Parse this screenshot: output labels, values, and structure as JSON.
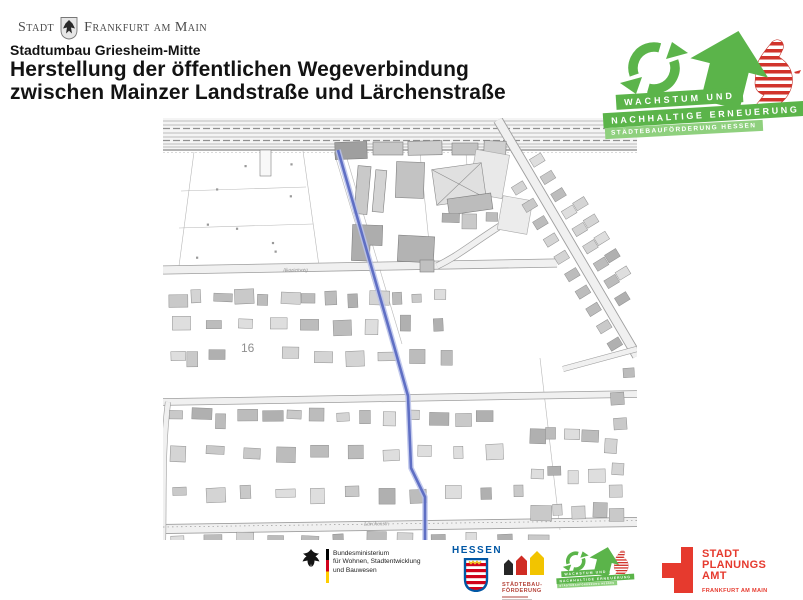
{
  "colors": {
    "green": "#5bb44a",
    "light_green": "#8fd07e",
    "hessen_blue": "#0057a5",
    "funding_red": "#b5443a",
    "planning_red": "#e63a2e",
    "path_blue": "#5f6fc4"
  },
  "header": {
    "city_logo": {
      "word1": "Stadt",
      "word2": "Frankfurt am Main"
    },
    "subtitle": "Stadtumbau Griesheim-Mitte",
    "title1": "Herstellung der öffentlichen Wegeverbindung",
    "title2": "zwischen Mainzer Landstraße und Lärchenstraße"
  },
  "program_logo": {
    "line1": "WACHSTUM UND",
    "line2": "NACHHALTIGE ERNEUERUNG",
    "line3": "STÄDTEBAUFÖRDERUNG HESSEN"
  },
  "map": {
    "street_label_mid": "Akazienweg",
    "street_label_bottom": "Lärchenstr.",
    "block_number": "16"
  },
  "footer": {
    "ministry": {
      "line1": "Bundesministerium",
      "line2": "für Wohnen, Stadtentwicklung",
      "line3": "und Bauwesen"
    },
    "hessen": {
      "wordmark": "HESSEN"
    },
    "funding": {
      "line1": "STÄDTEBAU-",
      "line2": "FÖRDERUNG"
    },
    "planning": {
      "line1": "STADT",
      "line2": "PLANUNGS",
      "line3": "AMT",
      "sub": "FRANKFURT AM MAIN"
    }
  }
}
